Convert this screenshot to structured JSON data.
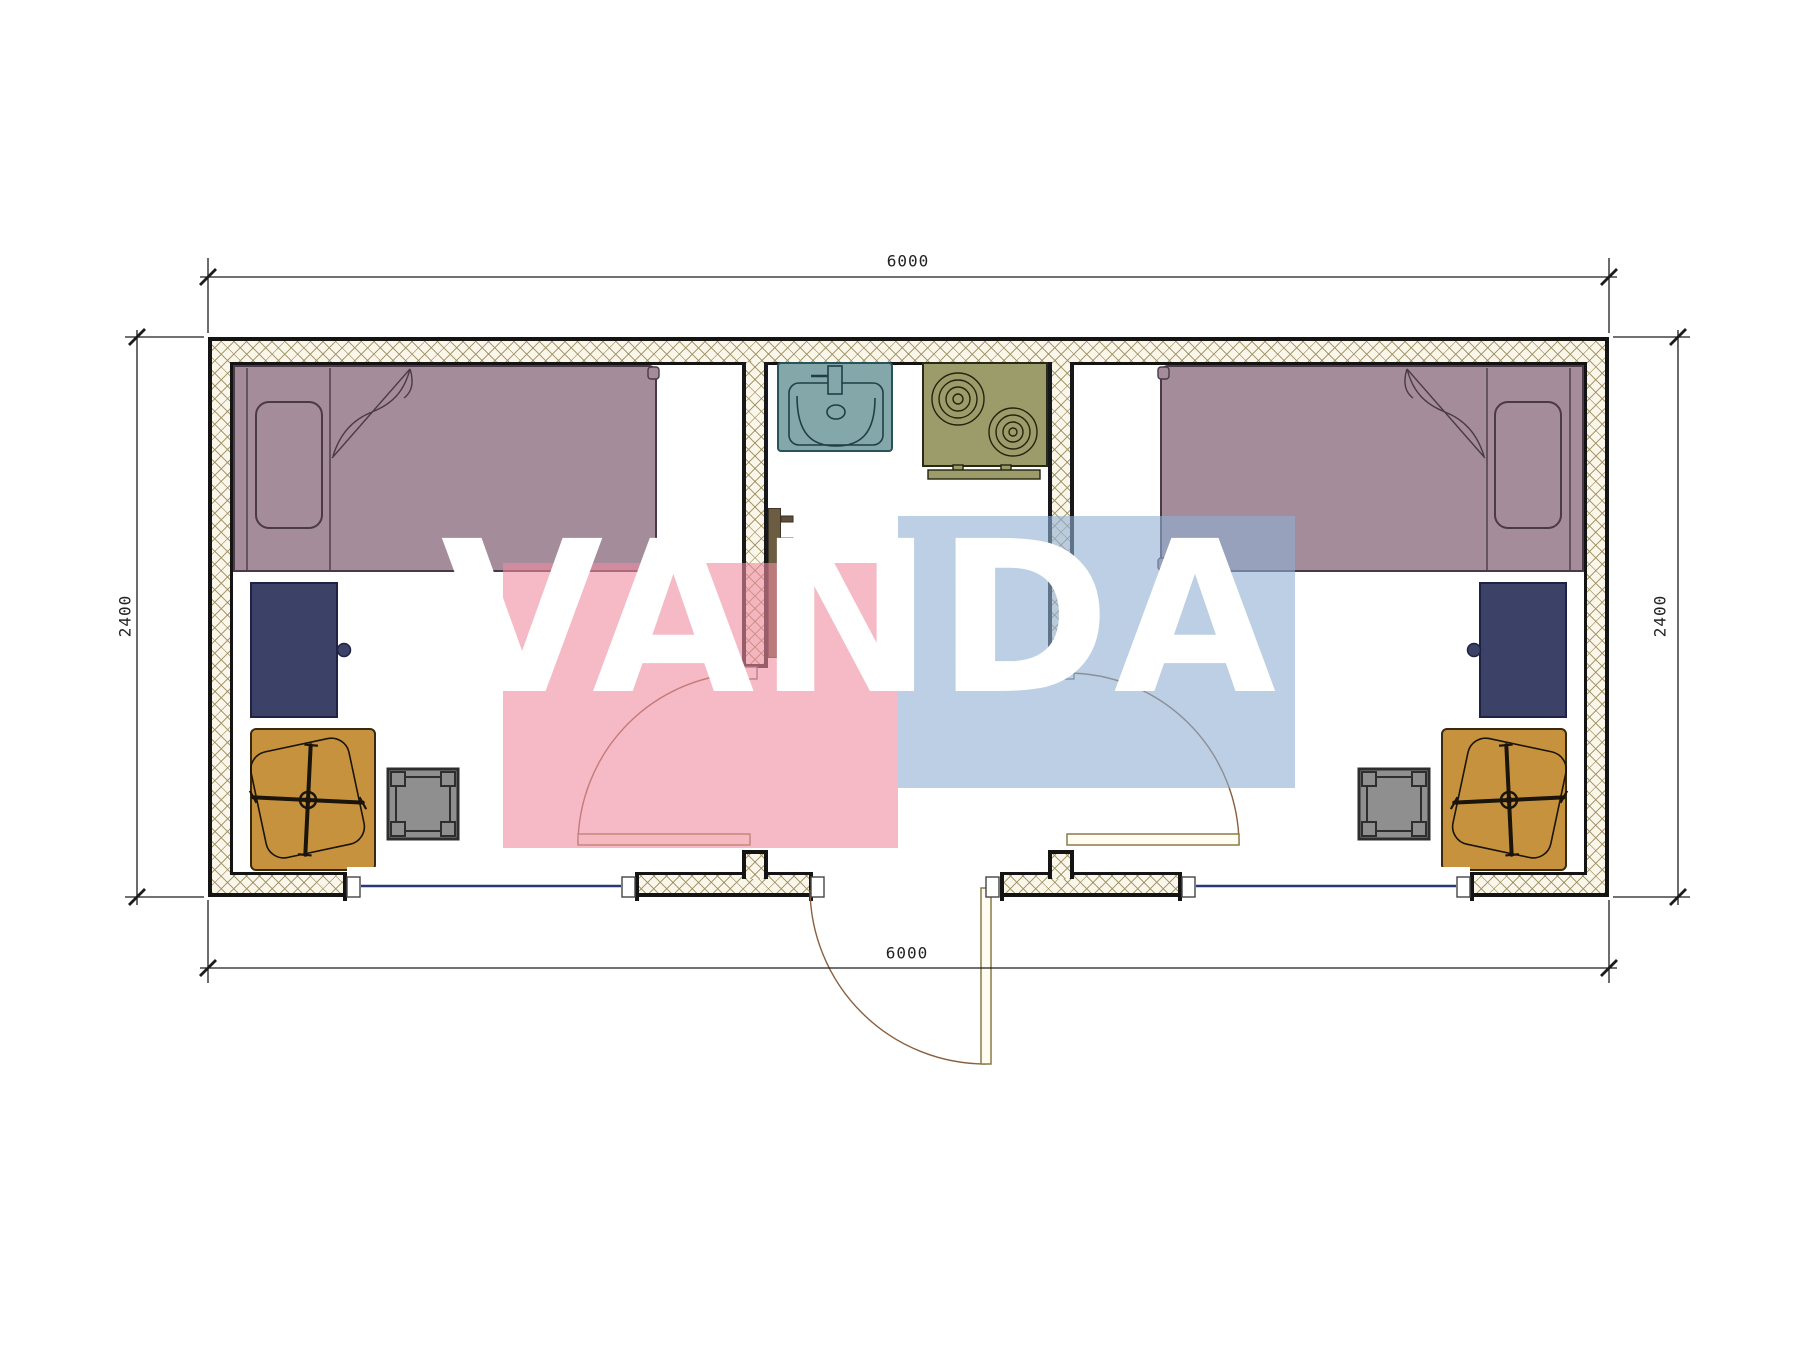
{
  "drawing": {
    "type": "floor-plan",
    "units": "mm"
  },
  "dimensions": {
    "top": "6000",
    "bottom": "6000",
    "left": "2400",
    "right": "2400"
  },
  "watermark": {
    "text": "VANDA",
    "pink": "#f2a6b7",
    "blue": "#a8c4e2"
  },
  "colors": {
    "wall_fill": "#faf6ea",
    "wall_hatch": "#9a8a5a",
    "outline": "#141414",
    "bed": "#a48c9b",
    "cabinet": "#3c4168",
    "desk": "#c7923e",
    "stool": "#8f8f8f",
    "sink": "#84a7a9",
    "stove": "#9c9c6a",
    "window": "#2a3878",
    "door_arc": "#8a6040"
  },
  "rooms": {
    "left_bedroom": [
      "bed",
      "pillow",
      "cabinet",
      "desk",
      "office-chair",
      "stool"
    ],
    "utility": [
      "sink",
      "stove",
      "towel-rail"
    ],
    "right_bedroom": [
      "bed",
      "pillow",
      "cabinet",
      "desk",
      "office-chair",
      "stool"
    ]
  }
}
